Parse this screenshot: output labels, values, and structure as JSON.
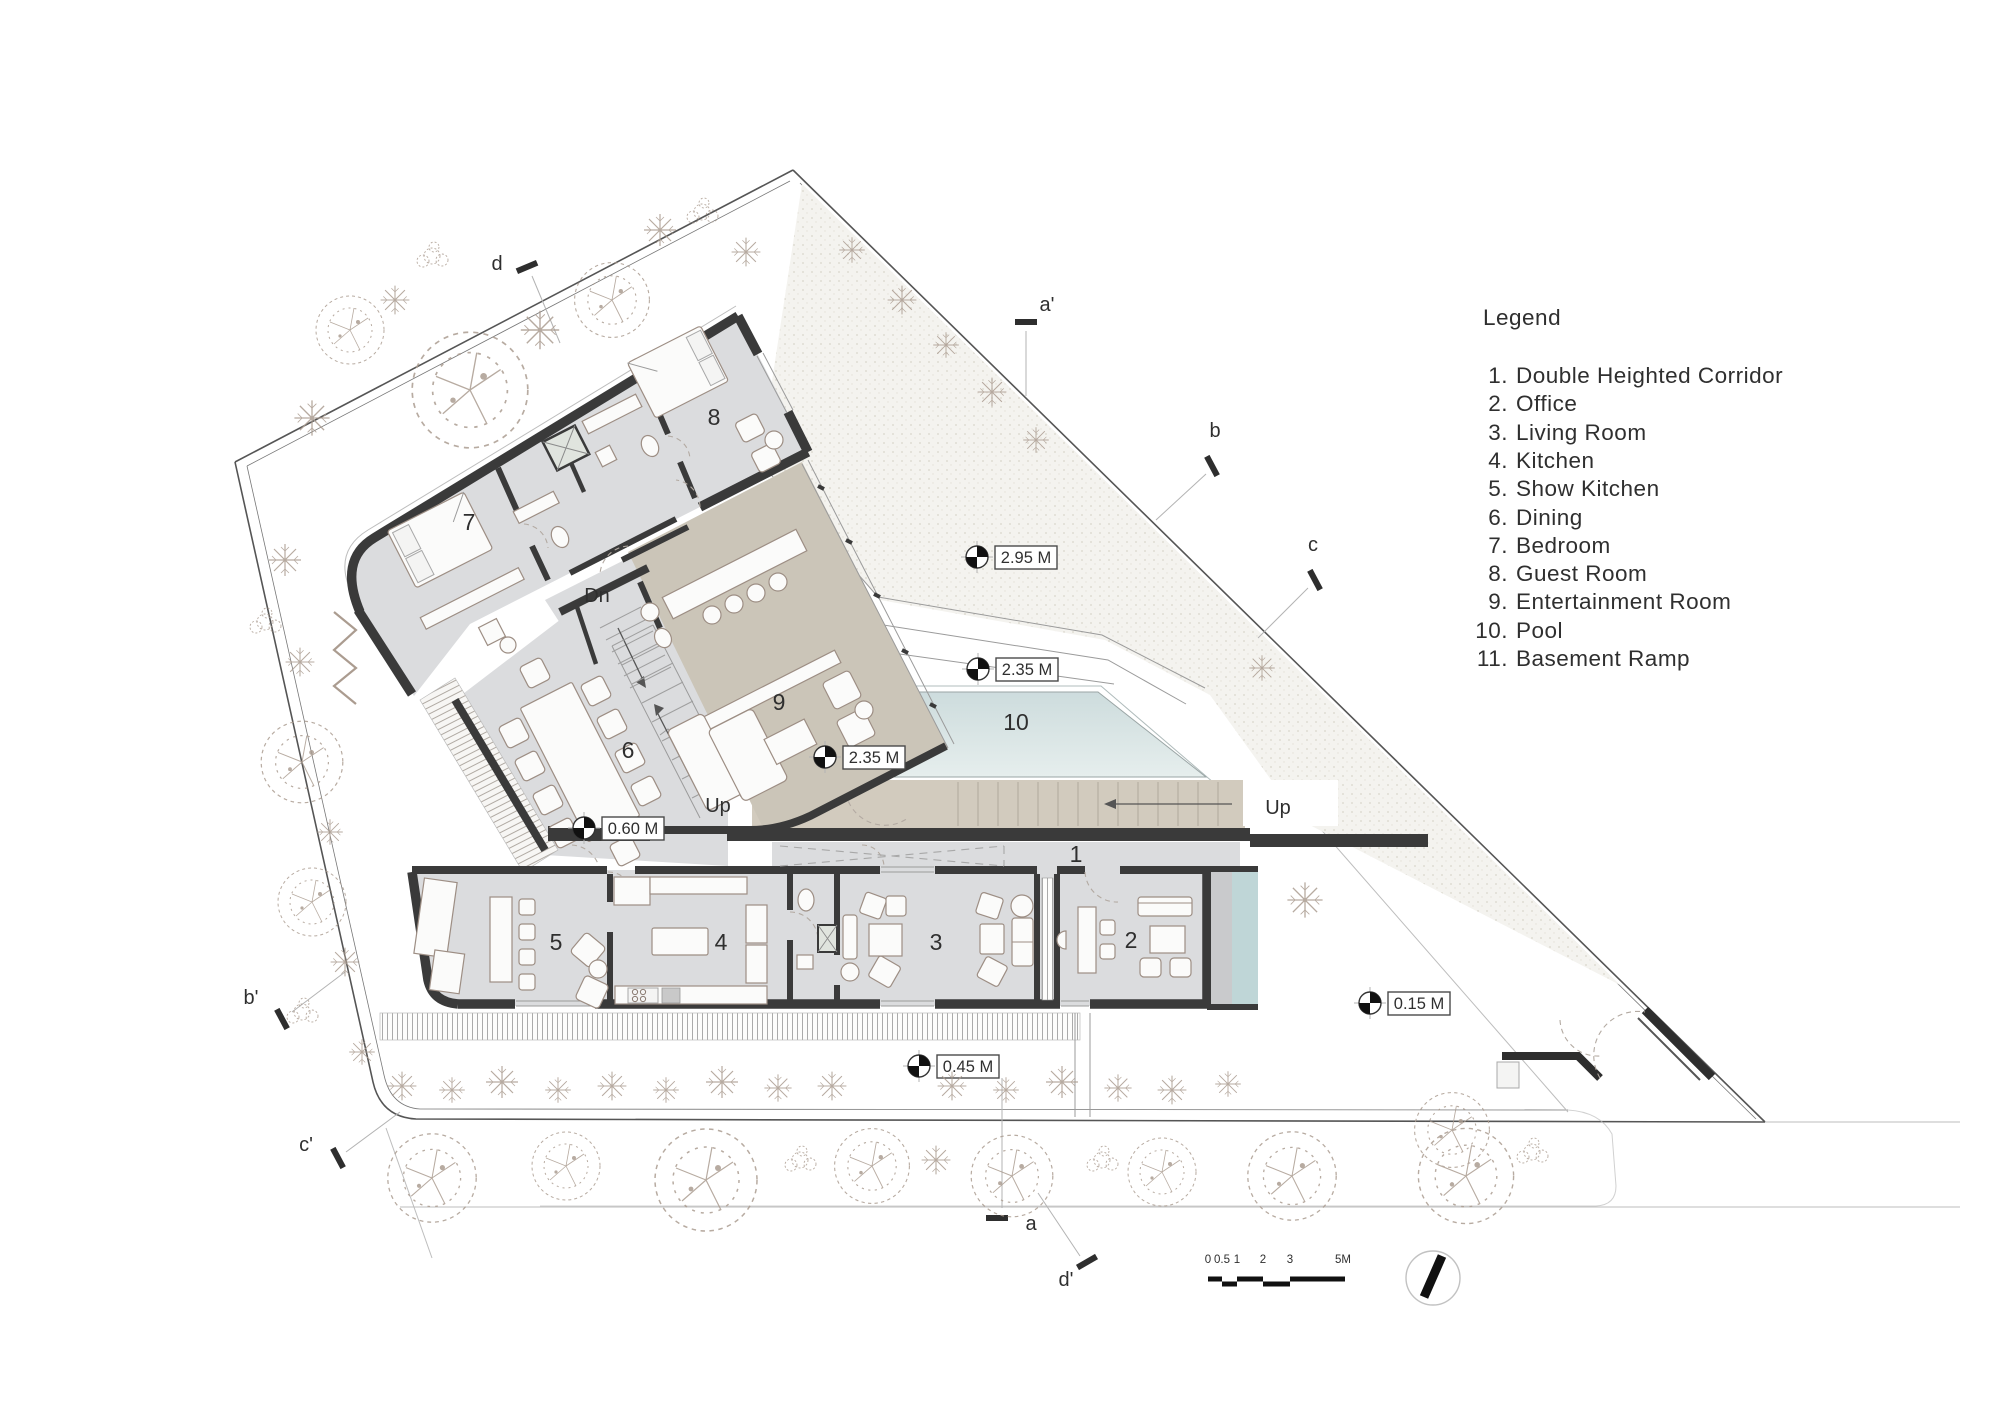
{
  "legend": {
    "title": "Legend",
    "items": [
      {
        "num": "1.",
        "label": "Double Heighted Corridor"
      },
      {
        "num": "2.",
        "label": "Office"
      },
      {
        "num": "3.",
        "label": "Living Room"
      },
      {
        "num": "4.",
        "label": "Kitchen"
      },
      {
        "num": "5.",
        "label": "Show Kitchen"
      },
      {
        "num": "6.",
        "label": "Dining"
      },
      {
        "num": "7.",
        "label": "Bedroom"
      },
      {
        "num": "8.",
        "label": "Guest Room"
      },
      {
        "num": "9.",
        "label": "Entertainment Room"
      },
      {
        "num": "10.",
        "label": "Pool"
      },
      {
        "num": "11.",
        "label": "Basement Ramp"
      }
    ]
  },
  "plan": {
    "room_numbers": {
      "r1": "1",
      "r2": "2",
      "r3": "3",
      "r4": "4",
      "r5": "5",
      "r6": "6",
      "r7": "7",
      "r8": "8",
      "r9": "9",
      "r10": "10"
    },
    "level_markers": [
      {
        "label": "2.95 M"
      },
      {
        "label": "2.35 M"
      },
      {
        "label": "2.35 M"
      },
      {
        "label": "0.60 M"
      },
      {
        "label": "0.15 M"
      },
      {
        "label": "0.45 M"
      }
    ],
    "stairs": {
      "up_main": "Up",
      "up_deck": "Up",
      "down": "Dn"
    },
    "sections": {
      "d": "d",
      "a_prime": "a'",
      "b": "b",
      "c": "c",
      "b_prime": "b'",
      "c_prime": "c'",
      "a": "a",
      "d_prime": "d'"
    },
    "scale_bar": {
      "ticks": [
        "0",
        "0.5",
        "1",
        "2",
        "3",
        "5M"
      ]
    }
  },
  "colors": {
    "ink": "#2f2f2f",
    "wall": "#3a3a3a",
    "floor": "#dbdcde",
    "room9": "#cbc5b8",
    "deckbeige": "#d2cbbe",
    "pool_top": "#cddcdd",
    "pool_bottom": "#e6eeed",
    "glass": "#bfd6d7",
    "lawn": "#f4f3ef",
    "tree": "#ab9c90"
  }
}
